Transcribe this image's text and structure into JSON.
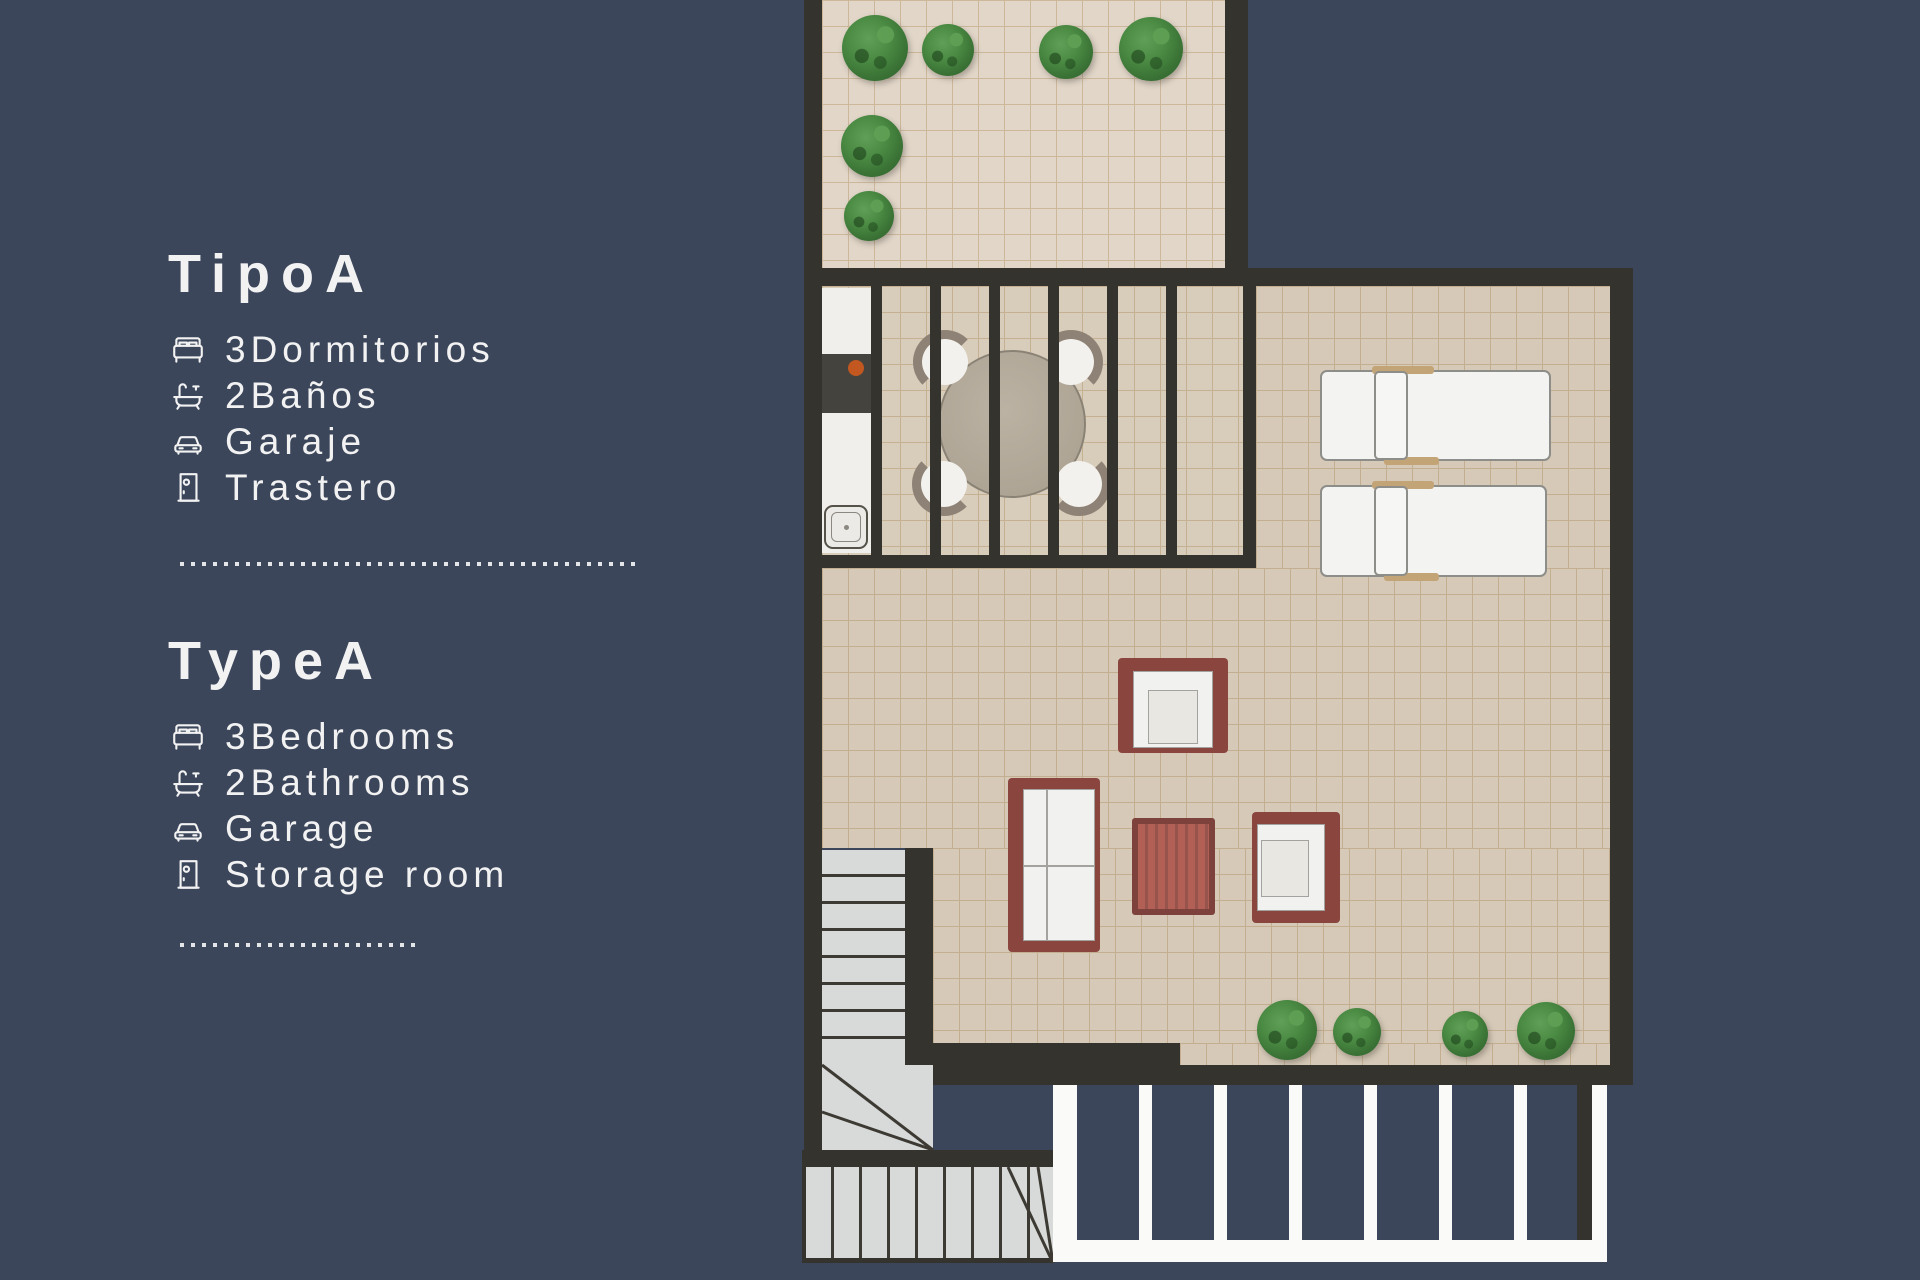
{
  "panel": {
    "sections": [
      {
        "id": "spanish",
        "title": "TipoA",
        "items": [
          {
            "icon": "bed-icon",
            "label": "3Dormitorios"
          },
          {
            "icon": "bathtub-icon",
            "label": "2Baños"
          },
          {
            "icon": "car-icon",
            "label": "Garaje"
          },
          {
            "icon": "door-icon",
            "label": "Trastero"
          }
        ]
      },
      {
        "id": "english",
        "title": "TypeA",
        "items": [
          {
            "icon": "bed-icon",
            "label": "3Bedrooms"
          },
          {
            "icon": "bathtub-icon",
            "label": "2Bathrooms"
          },
          {
            "icon": "car-icon",
            "label": "Garage"
          },
          {
            "icon": "door-icon",
            "label": "Storage room"
          }
        ]
      }
    ]
  },
  "floorplan": {
    "elements": [
      "upper-terrace",
      "planters",
      "kitchen-counter",
      "dining-table-with-4-chairs",
      "pergola-slats",
      "sun-loungers",
      "armchairs",
      "sofa",
      "coffee-table",
      "staircase",
      "garage-grille"
    ]
  },
  "colors": {
    "navy": "#3b465b",
    "wall": "#35332d",
    "text": "#f2f2f2",
    "tile": "#d6c9b7",
    "tileGrid": "#c4ae90",
    "terraceTile": "#e1d6c8",
    "terraceGrid": "#ccb79b",
    "diningTile": "#d8ccba",
    "diningGrid": "#c6b092",
    "stairs": "#d8dad9",
    "stairLine": "#3c3a33",
    "frameRed": "#8a453e",
    "tableRed": "#b26055",
    "slatRed": "#96544d",
    "cushion": "#f1f1ef",
    "cushionEdge": "#a3a29e",
    "seat": "#e9e7e1",
    "white": "#fafaf8",
    "tan": "#c3a477",
    "counterDark": "#45433e",
    "cooktopDot": "#c2571f",
    "tableTop": "#b1a797",
    "tableEdge": "#8a8375",
    "chairFringe": "#8d8275",
    "loungerEdge": "#8d8d89"
  }
}
